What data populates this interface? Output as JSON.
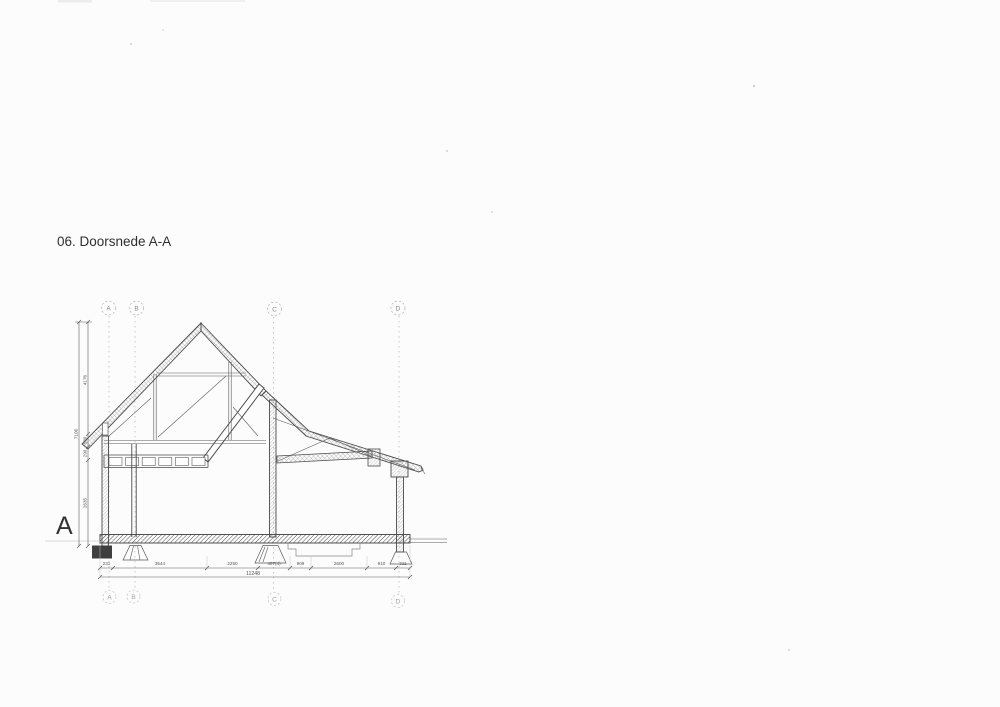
{
  "page": {
    "title": "06. Doorsnede A-A",
    "section_letter": "A"
  },
  "grid": {
    "top": [
      "A",
      "B",
      "C",
      "D"
    ],
    "bottom": [
      "A",
      "B",
      "C",
      "D"
    ]
  },
  "dims_horizontal": {
    "segments": [
      "231",
      "3544",
      "2250",
      "407(4)",
      "909",
      "2600",
      "910",
      "211"
    ],
    "total": "11248"
  },
  "dims_vertical": {
    "segments": [
      "4176",
      "580",
      "290",
      "2635"
    ],
    "total": "7106"
  },
  "colors": {
    "ink": "#4a4a4a",
    "faint": "#9b9b9b",
    "paper": "#fcfcfc"
  }
}
